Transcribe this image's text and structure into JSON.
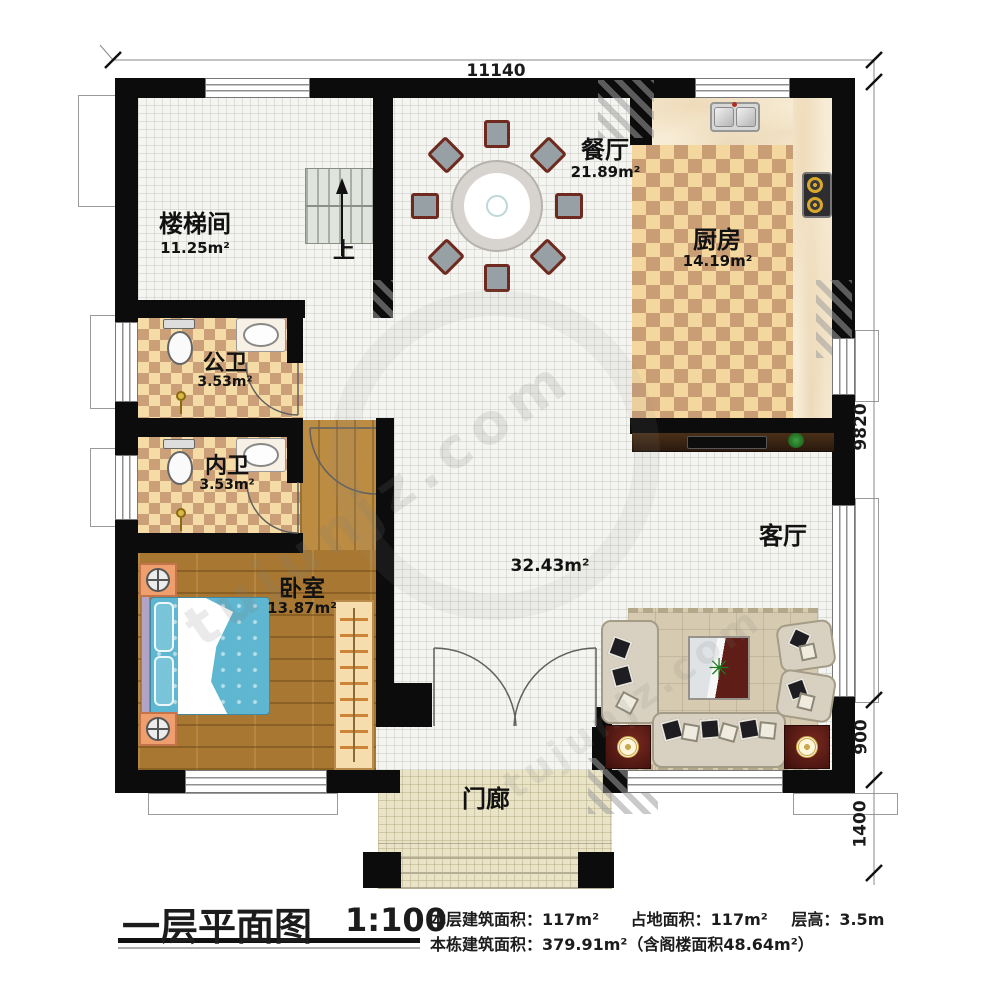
{
  "plan": {
    "dims": {
      "top": "11140",
      "right_main": "9820",
      "right_mid": "900",
      "right_low": "1400"
    },
    "rooms": {
      "stairwell": {
        "label": "楼梯间",
        "area": "11.25m²"
      },
      "dining": {
        "label": "餐厅",
        "area": "21.89m²"
      },
      "kitchen": {
        "label": "厨房",
        "area": "14.19m²"
      },
      "public_bath": {
        "label": "公卫",
        "area": "3.53m²"
      },
      "inner_bath": {
        "label": "内卫",
        "area": "3.53m²"
      },
      "bedroom": {
        "label": "卧室",
        "area": "13.87m²"
      },
      "living": {
        "label": "客厅",
        "area": "32.43m²"
      },
      "porch": {
        "label": "门廊"
      },
      "stairs_up": "上"
    }
  },
  "titleblock": {
    "title": "一层平面图",
    "scale": "1:100",
    "stats_line1_a": "本层建筑面积：117m²",
    "stats_line1_b": "占地面积：117m²",
    "stats_line1_c": "层高：3.5m",
    "stats_line2": "本栋建筑面积：379.91m²（含阁楼面积48.64m²）"
  },
  "watermark": {
    "text": "tujunjz.com"
  },
  "colors": {
    "wall": "#0c0c0c",
    "kitchen_tile": "#f3d79e",
    "wood": "#a87832",
    "bed": "#5fb6d0"
  }
}
